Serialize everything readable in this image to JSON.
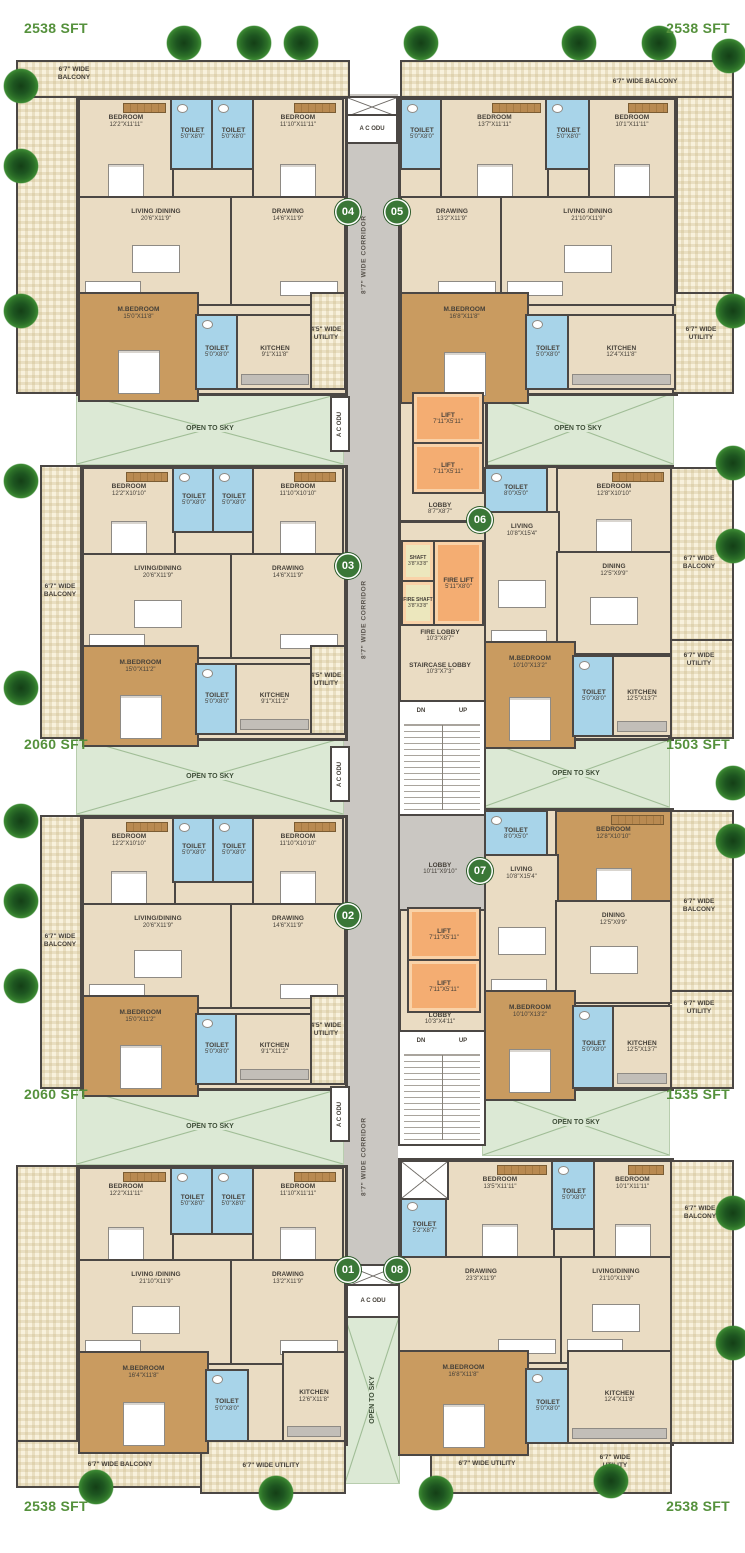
{
  "g": {
    "ots": "OPEN TO SKY",
    "ac": "A C ODU",
    "corr": "8'7\" WIDE CORRIDOR",
    "dn": "DN",
    "up": "UP"
  },
  "s": {
    "tl": "2538 SFT",
    "tr": "2538 SFT",
    "ml1": "2060 SFT",
    "mr1": "1503 SFT",
    "ml2": "2060 SFT",
    "mr2": "1535 SFT",
    "bl": "2538 SFT",
    "br": "2538 SFT"
  },
  "c": {
    "lift": {
      "n": "LIFT",
      "d": "7'11\"X5'11\""
    },
    "lob1": {
      "n": "LOBBY",
      "d": "8'7\"X8'7\""
    },
    "shaft": {
      "n": "SHAFT",
      "d": "3'8\"X3'8\""
    },
    "fshaft": {
      "n": "FIRE SHAFT",
      "d": "3'8\"X3'8\""
    },
    "flift": {
      "n": "FIRE LIFT",
      "d": "5'11\"X8'0\""
    },
    "flob": {
      "n": "FIRE LOBBY",
      "d": "10'3\"X8'7\""
    },
    "slob": {
      "n": "STAIRCASE LOBBY",
      "d": "10'3\"X7'3\""
    },
    "lob2": {
      "n": "LOBBY",
      "d": "10'11\"X9'10\""
    },
    "lob3": {
      "n": "LOBBY",
      "d": "10'3\"X4'11\""
    }
  },
  "u": {
    "u04": {
      "no": "04",
      "bal": "6'7\" WIDE\nBALCONY",
      "ut": "4'5\" WIDE\nUTILITY",
      "b1": {
        "n": "BEDROOM",
        "d": "12'2\"X11'11\""
      },
      "t1": {
        "n": "TOILET",
        "d": "5'0\"X8'0\""
      },
      "t2": {
        "n": "TOILET",
        "d": "5'0\"X8'0\""
      },
      "b2": {
        "n": "BEDROOM",
        "d": "11'10\"X11'11\""
      },
      "lv": {
        "n": "LIVING /DINING",
        "d": "20'6\"X11'9\""
      },
      "dr": {
        "n": "DRAWING",
        "d": "14'6\"X11'9\""
      },
      "mb": {
        "n": "M.BEDROOM",
        "d": "15'0\"X11'8\""
      },
      "t3": {
        "n": "TOILET",
        "d": "5'0\"X8'0\""
      },
      "kt": {
        "n": "KITCHEN",
        "d": "9'1\"X11'8\""
      }
    },
    "u05": {
      "no": "05",
      "bal": "6'7\" WIDE BALCONY",
      "ut": "6'7\" WIDE\nUTILITY",
      "t1": {
        "n": "TOILET",
        "d": "5'0\"X8'0\""
      },
      "b1": {
        "n": "BEDROOM",
        "d": "13'7\"X11'11\""
      },
      "t2": {
        "n": "TOILET",
        "d": "5'0\"X8'0\""
      },
      "b2": {
        "n": "BEDROOM",
        "d": "10'1\"X11'11\""
      },
      "dr": {
        "n": "DRAWING",
        "d": "13'2\"X11'9\""
      },
      "lv": {
        "n": "LIVING /DINING",
        "d": "21'10\"X11'9\""
      },
      "mb": {
        "n": "M.BEDROOM",
        "d": "16'8\"X11'8\""
      },
      "t3": {
        "n": "TOILET",
        "d": "5'0\"X8'0\""
      },
      "kt": {
        "n": "KITCHEN",
        "d": "12'4\"X11'8\""
      }
    },
    "u03": {
      "no": "03",
      "bal": "6'7\" WIDE\nBALCONY",
      "ut": "4'5\" WIDE\nUTILITY",
      "b1": {
        "n": "BEDROOM",
        "d": "12'2\"X10'10\""
      },
      "t1": {
        "n": "TOILET",
        "d": "5'0\"X8'0\""
      },
      "t2": {
        "n": "TOILET",
        "d": "5'0\"X8'0\""
      },
      "b2": {
        "n": "BEDROOM",
        "d": "11'10\"X10'10\""
      },
      "lv": {
        "n": "LIVING/DINING",
        "d": "20'6\"X11'9\""
      },
      "dr": {
        "n": "DRAWING",
        "d": "14'6\"X11'9\""
      },
      "mb": {
        "n": "M.BEDROOM",
        "d": "15'0\"X11'2\""
      },
      "t3": {
        "n": "TOILET",
        "d": "5'0\"X8'0\""
      },
      "kt": {
        "n": "KITCHEN",
        "d": "9'1\"X11'2\""
      }
    },
    "u06": {
      "no": "06",
      "bal": "6'7\" WIDE\nBALCONY",
      "ut": "6'7\" WIDE\nUTILITY",
      "t1": {
        "n": "TOILET",
        "d": "8'0\"X5'0\""
      },
      "b1": {
        "n": "BEDROOM",
        "d": "12'8\"X10'10\""
      },
      "lv": {
        "n": "LIVING",
        "d": "10'8\"X15'4\""
      },
      "dn": {
        "n": "DINING",
        "d": "12'5\"X9'9\""
      },
      "mb": {
        "n": "M.BEDROOM",
        "d": "10'10\"X13'2\""
      },
      "t2": {
        "n": "TOILET",
        "d": "5'0\"X8'0\""
      },
      "kt": {
        "n": "KITCHEN",
        "d": "12'5\"X13'7\""
      }
    },
    "u02": {
      "no": "02",
      "bal": "6'7\" WIDE\nBALCONY",
      "ut": "4'5\" WIDE\nUTILITY",
      "b1": {
        "n": "BEDROOM",
        "d": "12'2\"X10'10\""
      },
      "t1": {
        "n": "TOILET",
        "d": "5'0\"X8'0\""
      },
      "t2": {
        "n": "TOILET",
        "d": "5'0\"X8'0\""
      },
      "b2": {
        "n": "BEDROOM",
        "d": "11'10\"X10'10\""
      },
      "lv": {
        "n": "LIVING/DINING",
        "d": "20'6\"X11'9\""
      },
      "dr": {
        "n": "DRAWING",
        "d": "14'6\"X11'9\""
      },
      "mb": {
        "n": "M.BEDROOM",
        "d": "15'0\"X11'2\""
      },
      "t3": {
        "n": "TOILET",
        "d": "5'0\"X8'0\""
      },
      "kt": {
        "n": "KITCHEN",
        "d": "9'1\"X11'2\""
      }
    },
    "u07": {
      "no": "07",
      "bal": "6'7\" WIDE\nBALCONY",
      "ut": "6'7\" WIDE\nUTILITY",
      "t1": {
        "n": "TOILET",
        "d": "8'0\"X5'0\""
      },
      "b1": {
        "n": "BEDROOM",
        "d": "12'8\"X10'10\""
      },
      "lv": {
        "n": "LIVING",
        "d": "10'8\"X15'4\""
      },
      "dn": {
        "n": "DINING",
        "d": "12'5\"X9'9\""
      },
      "mb": {
        "n": "M.BEDROOM",
        "d": "10'10\"X13'2\""
      },
      "t2": {
        "n": "TOILET",
        "d": "5'0\"X8'0\""
      },
      "kt": {
        "n": "KITCHEN",
        "d": "12'5\"X13'7\""
      }
    },
    "u01": {
      "no": "01",
      "bal": "6'7\" WIDE BALCONY",
      "ut": "6'7\" WIDE UTILITY",
      "b1": {
        "n": "BEDROOM",
        "d": "12'2\"X11'11\""
      },
      "t1": {
        "n": "TOILET",
        "d": "5'0\"X8'0\""
      },
      "t2": {
        "n": "TOILET",
        "d": "5'0\"X8'0\""
      },
      "b2": {
        "n": "BEDROOM",
        "d": "11'10\"X11'11\""
      },
      "lv": {
        "n": "LIVING /DINING",
        "d": "21'10\"X11'9\""
      },
      "dr": {
        "n": "DRAWING",
        "d": "13'2\"X11'9\""
      },
      "mb": {
        "n": "M.BEDROOM",
        "d": "16'4\"X11'8\""
      },
      "t3": {
        "n": "TOILET",
        "d": "5'0\"X8'0\""
      },
      "kt": {
        "n": "KITCHEN",
        "d": "12'6\"X11'8\""
      }
    },
    "u08": {
      "no": "08",
      "bal": "6'7\" WIDE\nBALCONY",
      "utl": "6'7\" WIDE UTILITY",
      "utr": "6'7\" WIDE\nUTILITY",
      "t1": {
        "n": "TOILET",
        "d": "5'2\"X8'7\""
      },
      "b1": {
        "n": "BEDROOM",
        "d": "13'5\"X11'11\""
      },
      "t2": {
        "n": "TOILET",
        "d": "5'0\"X8'0\""
      },
      "b2": {
        "n": "BEDROOM",
        "d": "10'1\"X11'11\""
      },
      "dr": {
        "n": "DRAWING",
        "d": "23'3\"X11'9\""
      },
      "lv": {
        "n": "LIVING/DINING",
        "d": "21'10\"X11'9\""
      },
      "mb": {
        "n": "M.BEDROOM",
        "d": "16'8\"X11'8\""
      },
      "t3": {
        "n": "TOILET",
        "d": "5'0\"X8'0\""
      },
      "kt": {
        "n": "KITCHEN",
        "d": "12'4\"X11'8\""
      }
    }
  }
}
